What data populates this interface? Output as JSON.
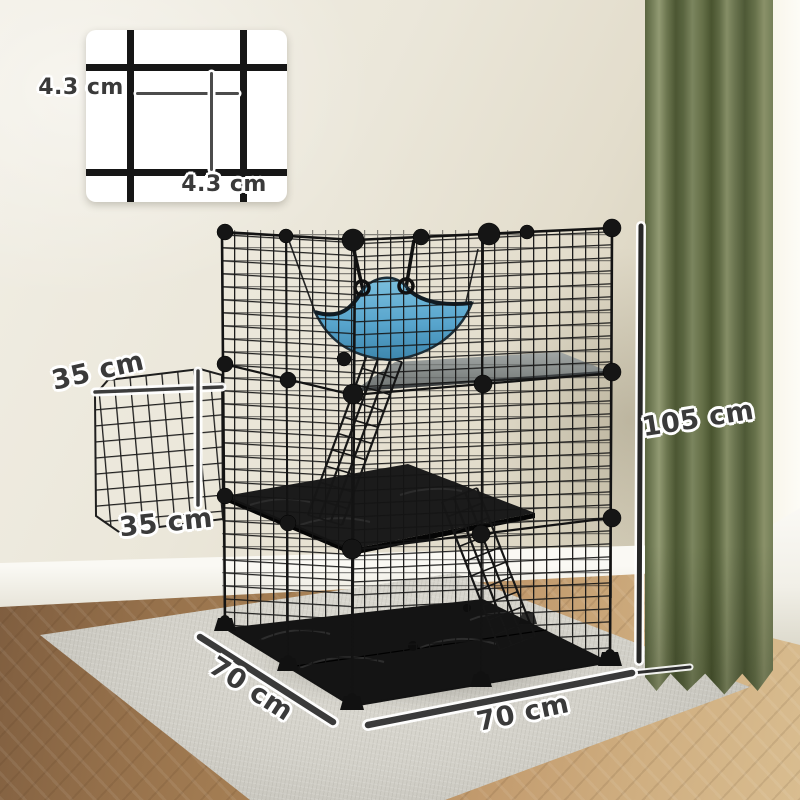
{
  "annotations": {
    "mesh_detail": {
      "label_left": "4.3 cm",
      "label_bottom": "4.3 cm"
    },
    "door_panel": {
      "label_top": "35 cm",
      "label_bottom": "35 cm"
    },
    "cage": {
      "height_label": "105 cm",
      "depth_label": "70 cm",
      "width_label": "70 cm"
    }
  },
  "colors": {
    "label_text": "#3a3a3a",
    "label_outline": "#ffffff",
    "cage_black": "#161616",
    "hammock_blue": "#5fa9cf",
    "curtain_green": "#6b7350",
    "rug_gray": "#d3d1c9",
    "floor_wood": "#b58a5e",
    "wall_beige": "#e8e4d6",
    "shelf_gray": "#8f9494"
  }
}
